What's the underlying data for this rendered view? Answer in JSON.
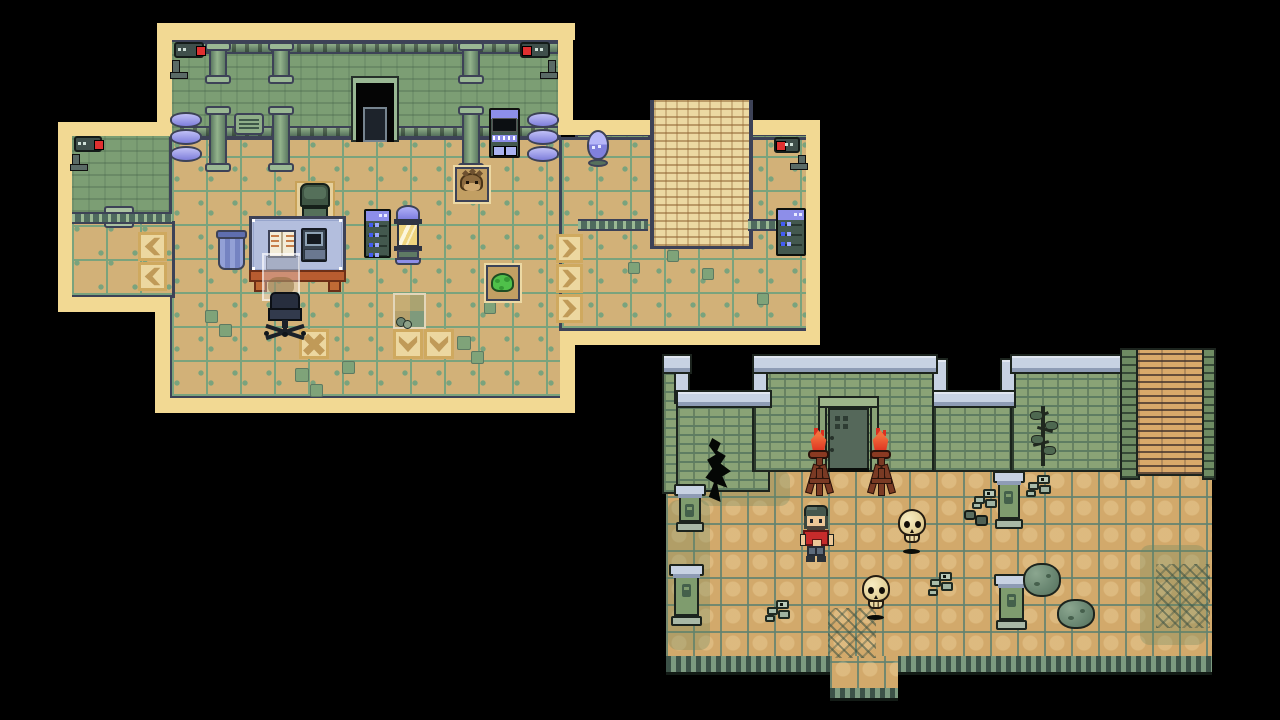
{
  "meta": {
    "view": "pixel-art RPG screenshot, two map captures on black background",
    "scene_left": "laboratory interior map",
    "scene_right": "ruins courtyard map",
    "background": "#000000"
  },
  "palette": {
    "cream": "#f2d993",
    "navy": "#3d4257",
    "wall_green": "#7c9e74",
    "floor_tan": "#d2b178",
    "grid_green": "#7aa37d",
    "arrow_tile": "#ecd7a0",
    "arrow_glyph": "#c09a58",
    "blue_item": "#8d8ee9",
    "led_blue": "#445df2",
    "desk_top": "#b3bedd",
    "desk_frame": "#b85c30",
    "slime_green": "#4fc04a",
    "camera_red": "#e03030",
    "cap_blue": "#c7d2e3",
    "brick_green": "#8aa376",
    "cobble_tan": "#d2a96b",
    "flame_red": "#dc2f1f",
    "flame_orange": "#f3703d",
    "skull_bone": "#efe0ac",
    "shirt_red": "#c62b2b",
    "pants_gray": "#5d6b7a",
    "pillar_green": "#7f9c6e",
    "boulder_green": "#6b8873",
    "tree_dark": "#20281f"
  },
  "maps": [
    {
      "id": "lab",
      "name": "lab-map",
      "rects": [
        {
          "n": "lab-wall",
          "t": "labwall",
          "x": 172,
          "y": 42,
          "w": 386,
          "h": 98
        },
        {
          "n": "lab-wall-west-wing",
          "t": "labwall",
          "x": 72,
          "y": 136,
          "w": 100,
          "h": 88
        },
        {
          "n": "lab-wall-alcove",
          "t": "labwall",
          "x": 578,
          "y": 136,
          "w": 70,
          "h": 95
        },
        {
          "n": "lab-wall-east-room",
          "t": "labwall",
          "x": 748,
          "y": 136,
          "w": 58,
          "h": 95
        },
        {
          "n": "lab-floor-main",
          "t": "labfloor",
          "x": 172,
          "y": 140,
          "w": 390,
          "h": 256
        },
        {
          "n": "lab-floor-corridor",
          "t": "labfloor",
          "x": 562,
          "y": 140,
          "w": 244,
          "h": 188
        },
        {
          "n": "lab-floor-west-wing",
          "t": "labfloor",
          "x": 72,
          "y": 224,
          "w": 100,
          "h": 71
        },
        {
          "n": "map-border",
          "t": "border",
          "x": 157,
          "y": 23,
          "w": 418,
          "h": 17
        },
        {
          "n": "map-border",
          "t": "border",
          "x": 157,
          "y": 23,
          "w": 15,
          "h": 100
        },
        {
          "n": "map-border",
          "t": "border",
          "x": 558,
          "y": 23,
          "w": 15,
          "h": 112
        },
        {
          "n": "map-border",
          "t": "border",
          "x": 58,
          "y": 122,
          "w": 114,
          "h": 14
        },
        {
          "n": "map-border",
          "t": "border",
          "x": 58,
          "y": 122,
          "w": 14,
          "h": 190
        },
        {
          "n": "map-border",
          "t": "border",
          "x": 58,
          "y": 297,
          "w": 99,
          "h": 15
        },
        {
          "n": "map-border",
          "t": "border",
          "x": 155,
          "y": 297,
          "w": 15,
          "h": 116
        },
        {
          "n": "map-border",
          "t": "border",
          "x": 155,
          "y": 398,
          "w": 420,
          "h": 15
        },
        {
          "n": "map-border",
          "t": "border",
          "x": 560,
          "y": 345,
          "w": 15,
          "h": 60
        },
        {
          "n": "map-border",
          "t": "border",
          "x": 573,
          "y": 120,
          "w": 77,
          "h": 15
        },
        {
          "n": "map-border",
          "t": "border",
          "x": 745,
          "y": 120,
          "w": 75,
          "h": 15
        },
        {
          "n": "map-border",
          "t": "border",
          "x": 806,
          "y": 120,
          "w": 14,
          "h": 225
        },
        {
          "n": "map-border",
          "t": "border",
          "x": 560,
          "y": 331,
          "w": 246,
          "h": 14
        },
        {
          "n": "ladder",
          "t": "ladderlab",
          "x": 650,
          "y": 100,
          "w": 95,
          "h": 146
        }
      ],
      "objects": [
        {
          "t": "rail",
          "x": 180,
          "y": 42,
          "w": 378,
          "h": 12
        },
        {
          "t": "rail",
          "x": 180,
          "y": 126,
          "w": 378,
          "h": 12
        },
        {
          "t": "pipe",
          "x": 205,
          "y": 42,
          "w": 26,
          "h": 42
        },
        {
          "t": "pipe",
          "x": 268,
          "y": 42,
          "w": 26,
          "h": 42
        },
        {
          "t": "pipe",
          "x": 458,
          "y": 42,
          "w": 26,
          "h": 42
        },
        {
          "t": "pipe",
          "x": 205,
          "y": 106,
          "w": 26,
          "h": 66
        },
        {
          "t": "pipe",
          "x": 268,
          "y": 106,
          "w": 26,
          "h": 66
        },
        {
          "t": "pipe",
          "x": 458,
          "y": 106,
          "w": 26,
          "h": 66
        },
        {
          "t": "vent",
          "x": 234,
          "y": 113,
          "w": 30,
          "h": 22
        },
        {
          "t": "doorway",
          "x": 351,
          "y": 76,
          "w": 48,
          "h": 66
        },
        {
          "t": "camera",
          "x": 170,
          "y": 42,
          "w": 38,
          "h": 36,
          "f": "right"
        },
        {
          "t": "camera",
          "x": 518,
          "y": 42,
          "w": 38,
          "h": 36,
          "f": "left"
        },
        {
          "t": "camera",
          "x": 70,
          "y": 136,
          "w": 36,
          "h": 34,
          "f": "right"
        },
        {
          "t": "camera",
          "x": 772,
          "y": 137,
          "w": 34,
          "h": 32,
          "f": "left"
        },
        {
          "t": "barrels",
          "x": 170,
          "y": 112,
          "w": 32,
          "h": 48
        },
        {
          "t": "barrels",
          "x": 527,
          "y": 112,
          "w": 32,
          "h": 48
        },
        {
          "t": "console",
          "x": 489,
          "y": 108,
          "w": 31,
          "h": 50
        },
        {
          "t": "grate",
          "x": 104,
          "y": 206,
          "w": 30,
          "h": 22
        },
        {
          "t": "railing",
          "x": 72,
          "y": 212,
          "w": 100,
          "h": 12
        },
        {
          "t": "railing",
          "x": 578,
          "y": 219,
          "w": 70,
          "h": 12
        },
        {
          "t": "railing",
          "x": 748,
          "y": 219,
          "w": 58,
          "h": 12
        },
        {
          "t": "egg",
          "x": 585,
          "y": 130,
          "w": 26,
          "h": 38
        },
        {
          "t": "serverrack",
          "x": 776,
          "y": 208,
          "w": 30,
          "h": 48,
          "rows": 3
        },
        {
          "t": "arrow",
          "x": 138,
          "y": 232,
          "w": 29,
          "h": 29,
          "f": "left"
        },
        {
          "t": "arrow",
          "x": 138,
          "y": 262,
          "w": 29,
          "h": 29,
          "f": "left"
        },
        {
          "t": "arrow",
          "x": 556,
          "y": 234,
          "w": 27,
          "h": 29,
          "f": "right"
        },
        {
          "t": "arrow",
          "x": 556,
          "y": 264,
          "w": 27,
          "h": 29,
          "f": "right"
        },
        {
          "t": "arrow",
          "x": 556,
          "y": 294,
          "w": 27,
          "h": 29,
          "f": "right"
        },
        {
          "t": "tilex",
          "x": 299,
          "y": 329,
          "w": 30,
          "h": 30
        },
        {
          "t": "arrow",
          "x": 393,
          "y": 329,
          "w": 30,
          "h": 30,
          "f": "down"
        },
        {
          "t": "arrow",
          "x": 424,
          "y": 329,
          "w": 30,
          "h": 30,
          "f": "down"
        },
        {
          "t": "floorvent",
          "x": 205,
          "y": 310,
          "w": 13,
          "h": 13
        },
        {
          "t": "floorvent",
          "x": 219,
          "y": 324,
          "w": 13,
          "h": 13
        },
        {
          "t": "floorvent",
          "x": 295,
          "y": 368,
          "w": 14,
          "h": 14
        },
        {
          "t": "floorvent",
          "x": 310,
          "y": 384,
          "w": 13,
          "h": 13
        },
        {
          "t": "floorvent",
          "x": 342,
          "y": 361,
          "w": 13,
          "h": 13
        },
        {
          "t": "floorvent",
          "x": 457,
          "y": 336,
          "w": 14,
          "h": 14
        },
        {
          "t": "floorvent",
          "x": 471,
          "y": 351,
          "w": 13,
          "h": 13
        },
        {
          "t": "floorvent",
          "x": 484,
          "y": 302,
          "w": 12,
          "h": 12
        },
        {
          "t": "floorvent",
          "x": 667,
          "y": 250,
          "w": 12,
          "h": 12
        },
        {
          "t": "floorvent",
          "x": 702,
          "y": 268,
          "w": 12,
          "h": 12
        },
        {
          "t": "floorvent",
          "x": 757,
          "y": 293,
          "w": 12,
          "h": 12
        },
        {
          "t": "floorvent",
          "x": 628,
          "y": 262,
          "w": 12,
          "h": 12
        },
        {
          "t": "trash",
          "x": 215,
          "y": 230,
          "w": 33,
          "h": 42
        },
        {
          "t": "chairgreen",
          "x": 295,
          "y": 181,
          "w": 40,
          "h": 52
        },
        {
          "t": "desk",
          "x": 249,
          "y": 216,
          "w": 97,
          "h": 76
        },
        {
          "t": "ghost",
          "x": 262,
          "y": 253,
          "w": 38,
          "h": 48
        },
        {
          "t": "chairoffice",
          "x": 263,
          "y": 292,
          "w": 44,
          "h": 44
        },
        {
          "t": "serverrack",
          "x": 364,
          "y": 209,
          "w": 27,
          "h": 49,
          "rows": 4
        },
        {
          "t": "capsule",
          "x": 394,
          "y": 205,
          "w": 28,
          "h": 60
        },
        {
          "t": "alcove",
          "x": 455,
          "y": 167,
          "w": 34,
          "h": 35,
          "c": "hedgehog"
        },
        {
          "t": "alcove",
          "x": 486,
          "y": 265,
          "w": 34,
          "h": 36,
          "c": "slime"
        },
        {
          "t": "trapdoor",
          "x": 393,
          "y": 293,
          "w": 33,
          "h": 36
        }
      ]
    },
    {
      "id": "ruins",
      "name": "ruins-map",
      "rects": [
        {
          "n": "cobble-floor",
          "t": "cobble",
          "x": 666,
          "y": 468,
          "w": 546,
          "h": 192
        },
        {
          "n": "moss-patch",
          "t": "moss",
          "x": 668,
          "y": 500,
          "w": 42,
          "h": 150
        },
        {
          "n": "moss-patch",
          "t": "moss",
          "x": 700,
          "y": 470,
          "w": 90,
          "h": 36
        },
        {
          "n": "moss-patch",
          "t": "moss",
          "x": 1140,
          "y": 545,
          "w": 66,
          "h": 100
        },
        {
          "n": "floor-trim",
          "t": "trim",
          "x": 666,
          "y": 656,
          "w": 546,
          "h": 16
        },
        {
          "n": "floor-exit",
          "t": "cobble",
          "x": 830,
          "y": 656,
          "w": 68,
          "h": 34
        },
        {
          "n": "floor-exit-trim",
          "t": "trim",
          "x": 830,
          "y": 688,
          "w": 68,
          "h": 10
        },
        {
          "n": "brick-wall",
          "t": "brick",
          "x": 664,
          "y": 370,
          "w": 24,
          "h": 122
        },
        {
          "n": "brick-wall",
          "t": "brick",
          "x": 678,
          "y": 404,
          "w": 90,
          "h": 86
        },
        {
          "n": "brick-wall",
          "t": "brick",
          "x": 754,
          "y": 370,
          "w": 182,
          "h": 100
        },
        {
          "n": "brick-wall",
          "t": "brick",
          "x": 934,
          "y": 404,
          "w": 80,
          "h": 66
        },
        {
          "n": "brick-wall",
          "t": "brick",
          "x": 1012,
          "y": 370,
          "w": 112,
          "h": 100
        },
        {
          "n": "wall-joint",
          "t": "joint",
          "x": 752,
          "y": 370,
          "w": 4,
          "h": 100
        },
        {
          "n": "wall-joint",
          "t": "joint",
          "x": 932,
          "y": 404,
          "w": 4,
          "h": 66
        },
        {
          "n": "wall-joint",
          "t": "joint",
          "x": 1010,
          "y": 370,
          "w": 4,
          "h": 100
        },
        {
          "n": "wall-cap",
          "t": "cap",
          "x": 676,
          "y": 360,
          "w": 12,
          "h": 42
        },
        {
          "n": "wall-cap",
          "t": "cap",
          "x": 754,
          "y": 360,
          "w": 12,
          "h": 42
        },
        {
          "n": "wall-cap",
          "t": "cap",
          "x": 934,
          "y": 360,
          "w": 12,
          "h": 42
        },
        {
          "n": "wall-cap",
          "t": "cap",
          "x": 1002,
          "y": 360,
          "w": 12,
          "h": 42
        },
        {
          "n": "wall-cap",
          "t": "cap",
          "x": 664,
          "y": 356,
          "w": 26,
          "h": 16
        },
        {
          "n": "wall-cap",
          "t": "cap",
          "x": 678,
          "y": 392,
          "w": 92,
          "h": 14
        },
        {
          "n": "wall-cap",
          "t": "cap",
          "x": 754,
          "y": 356,
          "w": 182,
          "h": 16
        },
        {
          "n": "wall-cap",
          "t": "cap",
          "x": 934,
          "y": 392,
          "w": 80,
          "h": 14
        },
        {
          "n": "wall-cap",
          "t": "cap",
          "x": 1012,
          "y": 356,
          "w": 112,
          "h": 16
        },
        {
          "n": "ladder-rail",
          "t": "railL",
          "x": 1122,
          "y": 350,
          "w": 16,
          "h": 128
        },
        {
          "n": "ladder-rungs",
          "t": "rungs",
          "x": 1138,
          "y": 350,
          "w": 68,
          "h": 124
        },
        {
          "n": "ladder-rail",
          "t": "railL",
          "x": 1204,
          "y": 350,
          "w": 10,
          "h": 128
        },
        {
          "n": "cracked-floor",
          "t": "crackpatch",
          "x": 1156,
          "y": 564,
          "w": 54,
          "h": 64
        },
        {
          "n": "cracked-floor",
          "t": "crackpatch",
          "x": 828,
          "y": 608,
          "w": 48,
          "h": 50
        }
      ],
      "objects": [
        {
          "t": "crack",
          "x": 702,
          "y": 438,
          "w": 34,
          "h": 64
        },
        {
          "t": "ruindoor",
          "x": 818,
          "y": 396,
          "w": 61,
          "h": 76
        },
        {
          "t": "torch",
          "x": 805,
          "y": 428,
          "w": 27,
          "h": 68
        },
        {
          "t": "torch",
          "x": 867,
          "y": 428,
          "w": 27,
          "h": 68
        },
        {
          "t": "tree",
          "x": 1027,
          "y": 402,
          "w": 32,
          "h": 68
        },
        {
          "t": "pillar",
          "x": 676,
          "y": 484,
          "w": 28,
          "h": 50
        },
        {
          "t": "pillar",
          "x": 995,
          "y": 471,
          "w": 28,
          "h": 60
        },
        {
          "t": "pillar",
          "x": 671,
          "y": 564,
          "w": 31,
          "h": 64
        },
        {
          "t": "pillar",
          "x": 996,
          "y": 574,
          "w": 31,
          "h": 58
        },
        {
          "t": "bones",
          "x": 1026,
          "y": 472,
          "w": 30,
          "h": 26
        },
        {
          "t": "bones",
          "x": 972,
          "y": 486,
          "w": 28,
          "h": 24
        },
        {
          "t": "rocks",
          "x": 962,
          "y": 505,
          "w": 28,
          "h": 24
        },
        {
          "t": "bones",
          "x": 928,
          "y": 569,
          "w": 32,
          "h": 28
        },
        {
          "t": "bones",
          "x": 765,
          "y": 597,
          "w": 30,
          "h": 26
        },
        {
          "t": "boulder",
          "x": 1023,
          "y": 560,
          "w": 38,
          "h": 40
        },
        {
          "t": "boulder",
          "x": 1057,
          "y": 596,
          "w": 38,
          "h": 36
        },
        {
          "t": "skull",
          "x": 897,
          "y": 509,
          "w": 30,
          "h": 46
        },
        {
          "t": "skull",
          "x": 861,
          "y": 575,
          "w": 30,
          "h": 46
        },
        {
          "t": "guy",
          "x": 799,
          "y": 505,
          "w": 34,
          "h": 57
        }
      ]
    }
  ]
}
